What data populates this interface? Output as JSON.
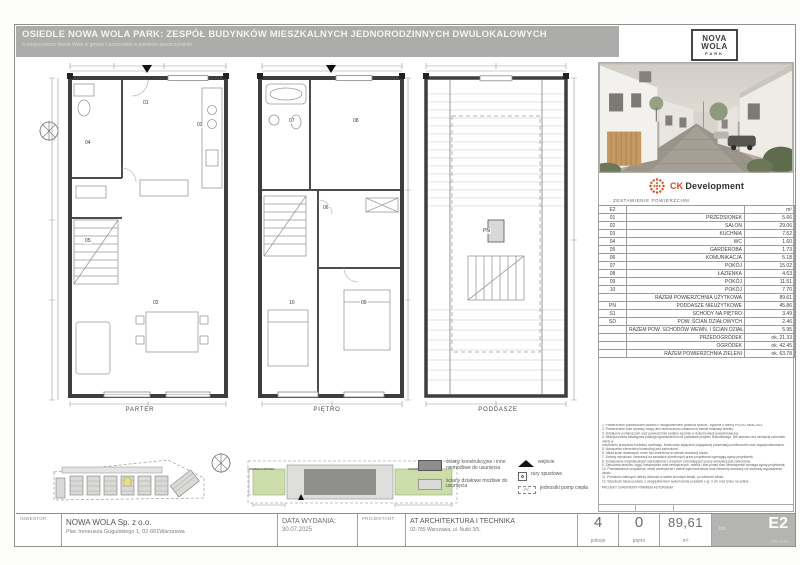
{
  "sheet": {
    "title": "OSIEDLE NOWA WOLA PARK: ZESPÓŁ BUDYNKÓW MIESZKALNYCH JEDNORODZINNYCH DWULOKALOWYCH",
    "subtitle": "w miejscowości Nowa Wola w gminie Lesznowola w powiecie piaseczyńskim"
  },
  "brand": {
    "park_logo": {
      "line1": "NOVA",
      "line2": "WOLA",
      "line3": "PARK"
    },
    "developer": {
      "prefix": "CK",
      "name": "Development"
    }
  },
  "plans": [
    {
      "label": "PARTER",
      "rooms": [
        {
          "code": "01"
        },
        {
          "code": "02"
        },
        {
          "code": "03"
        },
        {
          "code": "04"
        },
        {
          "code": "05"
        }
      ]
    },
    {
      "label": "PIĘTRO",
      "rooms": [
        {
          "code": "06"
        },
        {
          "code": "07"
        },
        {
          "code": "08"
        },
        {
          "code": "09"
        },
        {
          "code": "10"
        }
      ]
    },
    {
      "label": "PODDASZE",
      "rooms": [
        {
          "code": "PN"
        }
      ]
    }
  ],
  "area_table": {
    "title": "ZESTAWIENIE POWIERZCHNI",
    "unit_code": "E2",
    "unit_header": "m²",
    "rows": [
      {
        "code": "01",
        "name": "PRZEDSIONEK",
        "value": "5.66"
      },
      {
        "code": "02",
        "name": "SALON",
        "value": "29.06"
      },
      {
        "code": "03",
        "name": "KUCHNIA",
        "value": "7.52"
      },
      {
        "code": "04",
        "name": "WC",
        "value": "1.60"
      },
      {
        "code": "05",
        "name": "GARDEROBA",
        "value": "1.73"
      },
      {
        "code": "06",
        "name": "KOMUNIKACJA",
        "value": "5.18"
      },
      {
        "code": "07",
        "name": "POKÓJ",
        "value": "15.02"
      },
      {
        "code": "08",
        "name": "ŁAZIENKA",
        "value": "4.63"
      },
      {
        "code": "09",
        "name": "POKÓJ",
        "value": "11.51"
      },
      {
        "code": "10",
        "name": "POKÓJ",
        "value": "7.70"
      },
      {
        "code": "",
        "name": "RAZEM POWIERZCHNIA UŻYTKOWA",
        "value": "89.61"
      },
      {
        "code": "PN",
        "name": "PODDASZE NIEUŻYTKOWE",
        "value": "45.86"
      },
      {
        "code": "S1",
        "name": "SCHODY NA PIĘTRO",
        "value": "3.49"
      },
      {
        "code": "SD",
        "name": "POW. ŚCIAN DZIAŁOWYCH",
        "value": "2.46"
      },
      {
        "code": "",
        "name": "RAZEM POW. SCHODÓW WEWN. I ŚCIAN DZIAŁ.",
        "value": "5.95"
      },
      {
        "code": "",
        "name": "PRZEDOGRÓDEK",
        "value": "ok. 21.33"
      },
      {
        "code": "",
        "name": "OGRÓDEK",
        "value": "ok. 42.45"
      },
      {
        "code": "",
        "name": "RAZEM POWIERZCHNIA ZIELENI",
        "value": "ok. 63.78"
      }
    ]
  },
  "notes": {
    "lines": [
      "1. Powierzchnie pomieszczeń podano z uwzględnieniem grubości tynków - zgodnie z normą PN-ISO 9836:2022.",
      "2. Powierzchnie oraz wymiary mogą ulec nieznacznym zmianom w trakcie realizacji obiektu.",
      "3. Oddalenie pomieszczeń oraz powierzchnie podano zgodnie w dokumentacji powykonawczej.",
      "4. Niniejsza karta katalogowa podlega ograniczeniom na podstawie projektu budowlanego. Nie stanowi ona niniejszej schematu oferty w",
      "rozumieniu przepisów Kodeksu cywilnego. Karta służy wyłącznie poglądowej prezentacji pomieszczeń oraz zagospodarowania.",
      "5. Naruszenie elementów konstrukcji jest zabronione.",
      "6. Układ ścian działowych może być zmieniony w ramach aranżacji lokalu.",
      "7. Zmiany wysokości i aranżacji na zasadach określonych przez projektanta wymagają zgody projektanta.",
      "8. Instalowanie indywidualnych wentylatorów i urządzeń zmieniających pracę wentylacji jest zabronione.",
      "9. Zabudowa tarasów, loggi, instalowanie rolet zewnętrznych, markiz i krat ponad stan deweloperski wymaga zgody projektanta.",
      "10. Przedstawione urządzenia, strefy wewnętrzne i meble wykończeniowe oraz elementy aranżacji nie stanowią wyposażenia lokalu.",
      "11. Pomiarów własnych należy dokonać w stanie surowym lokalu, po odbiorze lokalu.",
      "12. Wysokość lokalu podano z uwzględnieniem wykończenia posadzki o gr. 2 cm oraz tynku na suficie."
    ],
    "footer": "PROJEKT CHRONIONY PRAWEM AUTORSKIM"
  },
  "site": {
    "przedogrodek": "PRZEDOGRÓDEK",
    "ogrodek": "OGRÓDEK"
  },
  "legend": {
    "structural": "ściany konstrukcyjne i inne niemożliwe do usunięcia",
    "partition": "ściany działowe możliwe do usunięcia",
    "entrance": "wejście",
    "pipes": "rury spustowe",
    "heat_pump": "jednostki pomp ciepła",
    "pc_label": "PC"
  },
  "title_block": {
    "inwestor_label": "INWESTOR:",
    "inwestor_name": "NOWA WOLA Sp. z o.o.",
    "inwestor_address": "Plac Ireneusza Gugulskiego 1, 02-661Warszawa",
    "issue_label": "DATA WYDANIA:",
    "issue_date": "30.07.2025",
    "designer_label": "PROJEKTANT:",
    "designer_name": "AT    ARCHITEKTURA I TECHNIKA",
    "designer_address": "02-785 Warszawa,  ul. Nutki 3/5,",
    "rooms_value": "4",
    "rooms_label": "pokoje",
    "floor_value": "0",
    "floor_label": "piętro",
    "area_value": "89,61",
    "area_unit": "m²",
    "lok_label": "lok.",
    "lok_code": "E2",
    "lok_sub": "Z02 B16"
  }
}
